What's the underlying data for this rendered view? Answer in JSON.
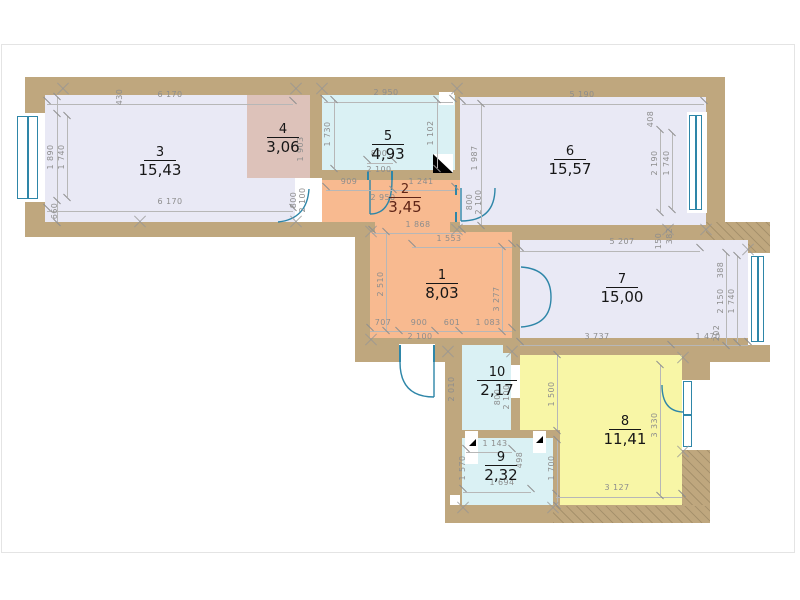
{
  "drawing": {
    "type": "apartment-floor-plan"
  },
  "palette": {
    "wall": "#bfa77e",
    "room_lavender": "#e9e9f5",
    "room_pink": "#ddc2ba",
    "room_cyan": "#daf1f4",
    "room_salmon": "#f8ba90",
    "room_yellow": "#f8f6a6",
    "fixture_blue": "#2e86a8",
    "dimension_gray": "#8d8d8d",
    "label_black": "#161616",
    "label_maroon": "#5f2517"
  },
  "rooms": [
    {
      "number": "1",
      "area": "8,03"
    },
    {
      "number": "2",
      "area": "3,45"
    },
    {
      "number": "3",
      "area": "15,43"
    },
    {
      "number": "4",
      "area": "3,06"
    },
    {
      "number": "5",
      "area": "4,93"
    },
    {
      "number": "6",
      "area": "15,57"
    },
    {
      "number": "7",
      "area": "15,00"
    },
    {
      "number": "8",
      "area": "11,41"
    },
    {
      "number": "9",
      "area": "2,32"
    },
    {
      "number": "10",
      "area": "2,17"
    }
  ],
  "dims": {
    "room3": {
      "top": "6 170",
      "bottom": "6 170",
      "left_a": "1 890",
      "left_b": "1 740",
      "offset_top": "430",
      "offset_bottom": "660"
    },
    "room4": {
      "height": "1 903"
    },
    "room5": {
      "top": "2 950",
      "left": "1 730",
      "right": "1 102",
      "door_w": "800",
      "door_h": "2 100"
    },
    "room2": {
      "seg_left": "909",
      "seg_right": "1 241",
      "width": "2 950",
      "bottom": "1 868",
      "door_w": "800",
      "door_h": "2 100"
    },
    "room6": {
      "top": "5 190",
      "left": "1 987",
      "right_offset": "408",
      "right_a": "2 190",
      "right_b": "1 740",
      "door_w": "800",
      "door_h": "2 100"
    },
    "room1": {
      "top": "1 553",
      "left": "2 510",
      "right": "3 277",
      "bottom_1": "707",
      "bottom_2": "900",
      "bottom_3": "601",
      "bottom_4": "1 083",
      "door_h": "2 100"
    },
    "room7": {
      "top": "5 207",
      "step_a": "150",
      "step_b": "382",
      "right_offset": "388",
      "right_a": "2 150",
      "right_b": "1 740",
      "right_bottom": "202",
      "bottom_left": "3 737",
      "bottom_right": "1 470"
    },
    "room10": {
      "height": "2 010",
      "door_w": "800",
      "door_h": "2 100"
    },
    "room8": {
      "left_upper": "1 500",
      "left_lower": "1 700",
      "right": "3 330",
      "bottom": "3 127"
    },
    "room9": {
      "top": "1 143",
      "left": "1 570",
      "right": "498",
      "bottom": "1 694"
    }
  }
}
